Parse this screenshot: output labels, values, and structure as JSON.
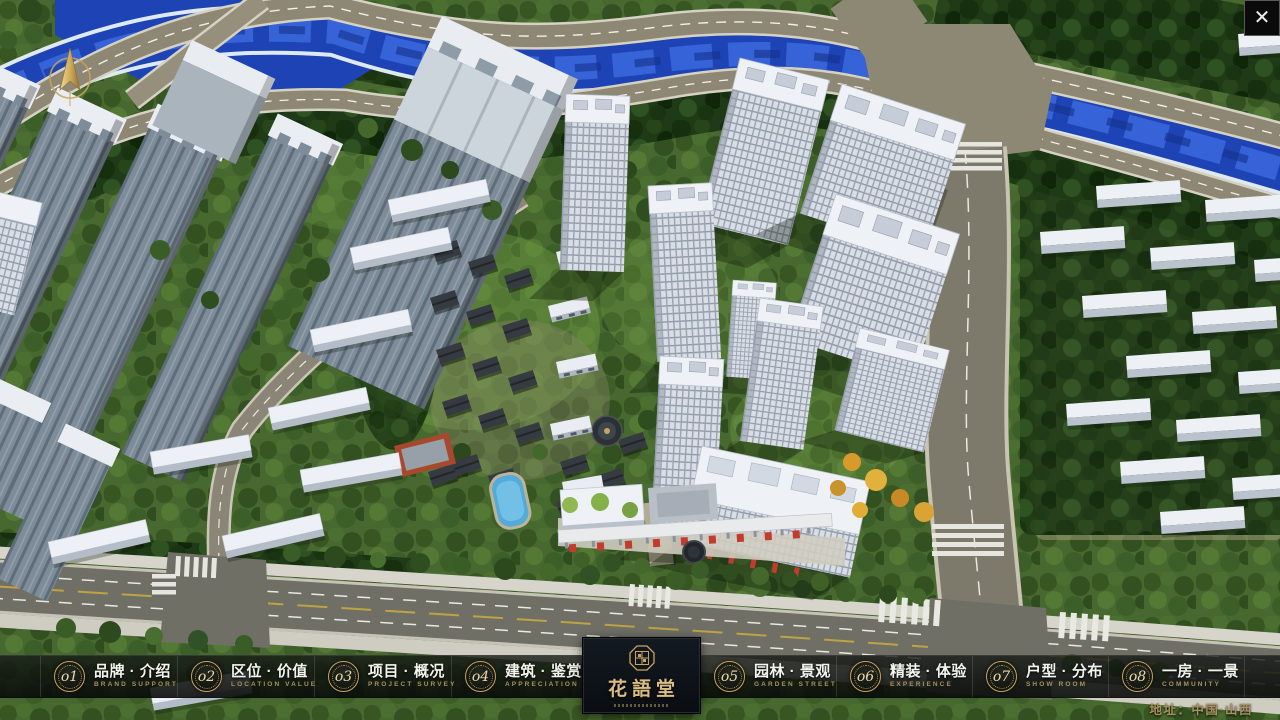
{
  "scene": {
    "name": "aerial-masterplan-render"
  },
  "icons": {
    "close": "✕"
  },
  "nav": {
    "items": [
      {
        "num": "o1",
        "label": "品牌 · 介绍",
        "sub": "BRAND SUPPORT"
      },
      {
        "num": "o2",
        "label": "区位 · 价值",
        "sub": "LOCATION VALUE"
      },
      {
        "num": "o3",
        "label": "项目 · 概况",
        "sub": "PROJECT SURVEY"
      },
      {
        "num": "o4",
        "label": "建筑 · 鉴赏",
        "sub": "APPRECIATION"
      },
      {
        "num": "o5",
        "label": "园林 · 景观",
        "sub": "GARDEN STREET"
      },
      {
        "num": "o6",
        "label": "精装 · 体验",
        "sub": "EXPERIENCE"
      },
      {
        "num": "o7",
        "label": "户型 · 分布",
        "sub": "SHOW ROOM"
      },
      {
        "num": "o8",
        "label": "一房 · 一景",
        "sub": "COMMUNITY"
      }
    ]
  },
  "logo": {
    "title": "花語堂"
  },
  "footer": {
    "address": "地址：中国·山西"
  },
  "colors": {
    "gold": "#c9a35f",
    "gold_text": "#a8915e",
    "bar_bg": "rgba(12,16,13,0.82)",
    "water": "#1d43b5",
    "accent_red": "#c23b2e"
  }
}
